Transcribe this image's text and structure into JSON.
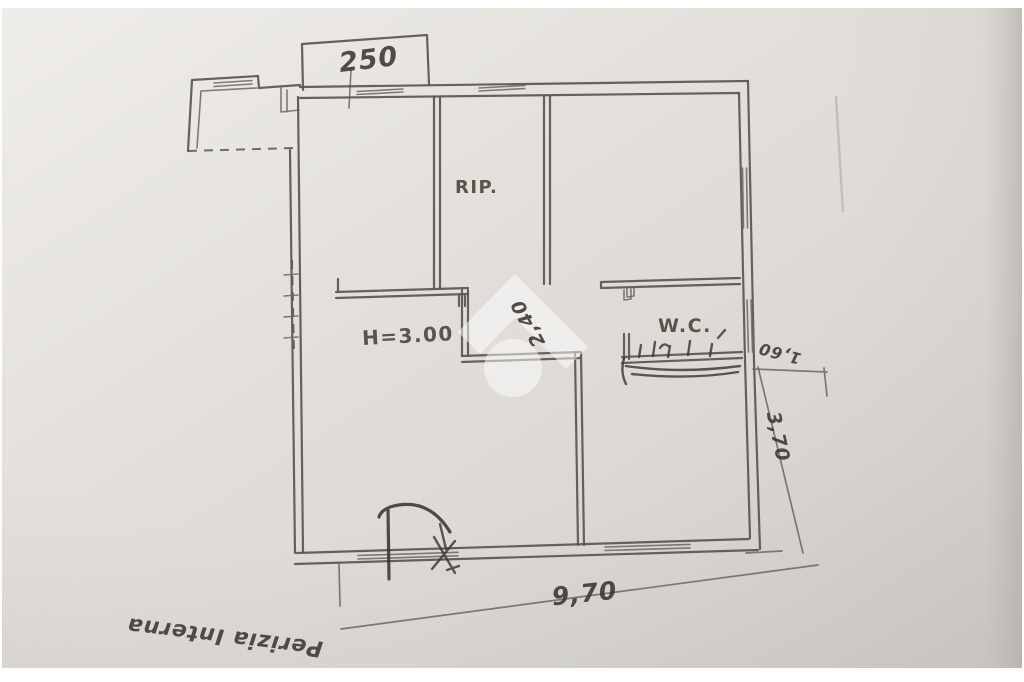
{
  "plan": {
    "rooms": {
      "storage": "RIP.",
      "toilet": "W.C."
    },
    "height_note": "H=3.00",
    "dimensions": {
      "top_balcony": "250",
      "bottom_width": "9,70",
      "right_depth": "3,70",
      "right_step": "1,60",
      "inner_passage": "2,40"
    },
    "handwritten_note": "Perizia Interna",
    "watermark_icon": "house-watermark-icon",
    "colors": {
      "paper_light": "#eceae7",
      "paper_dark": "#d2cfca",
      "wall_line": "#5a554f",
      "ink": "#38342f",
      "watermark": "#ffffff"
    }
  }
}
